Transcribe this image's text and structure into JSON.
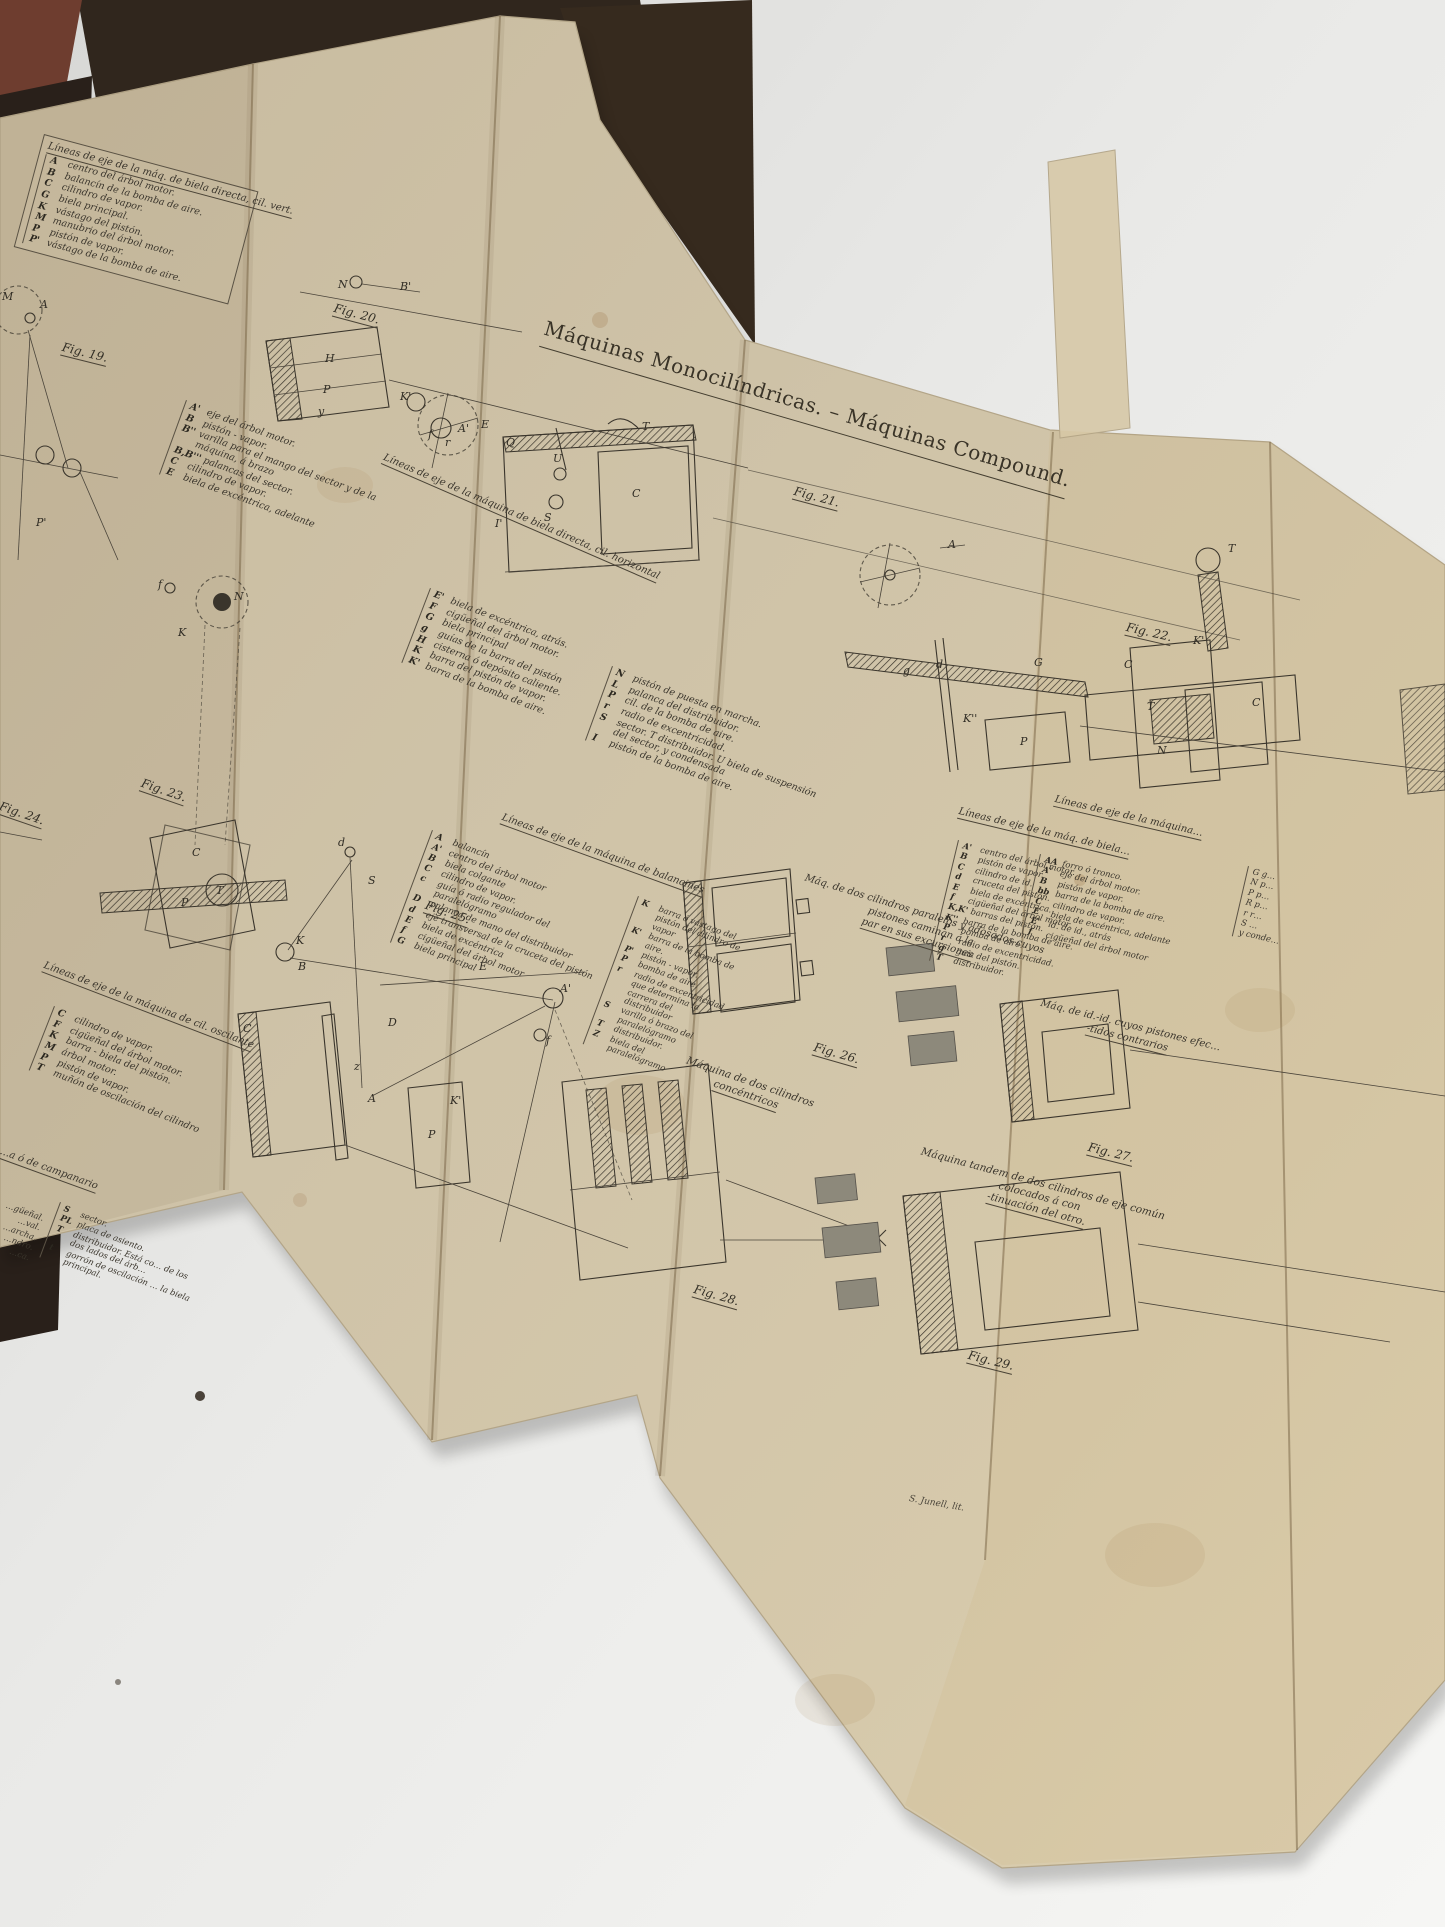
{
  "title": "Máquinas Monocilíndricas. – Máquinas Compound.",
  "signature": "S. Junell, lit.",
  "colors": {
    "paper": "#cfc3a8",
    "paper_right": "#d6c8a6",
    "ink": "#3a352c",
    "book_cover": "#30261d",
    "cover_red_edge": "#6e3d2f",
    "table_surface": "#ececea"
  },
  "lists": {
    "vert": {
      "header": "Líneas de eje de la máq. de biela directa, cil. vert.",
      "items": [
        {
          "k": "A",
          "t": "centro del árbol motor."
        },
        {
          "k": "B",
          "t": "balancín de la bomba de aire."
        },
        {
          "k": "C",
          "t": "cilindro de vapor."
        },
        {
          "k": "G",
          "t": "biela principal."
        },
        {
          "k": "K",
          "t": "vástago del pistón."
        },
        {
          "k": "M",
          "t": "manubrio del árbol motor."
        },
        {
          "k": "P",
          "t": "pistón de vapor."
        },
        {
          "k": "P'",
          "t": "vástago de la bomba de aire."
        }
      ]
    },
    "horiz": {
      "header": "Líneas de eje de la máquina de biela directa, cil. horizontal",
      "col1": [
        {
          "k": "A'",
          "t": "eje del árbol motor."
        },
        {
          "k": "B",
          "t": "pistón - vapor."
        },
        {
          "k": "B''",
          "t": "varilla para el mango del sector y de la máquina, á brazo"
        },
        {
          "k": "B,B'''",
          "t": "palancas del sector."
        },
        {
          "k": "C",
          "t": "cilindro de vapor."
        },
        {
          "k": "E",
          "t": "biela de excéntrica, adelante"
        }
      ],
      "col2": [
        {
          "k": "E'",
          "t": "biela de excéntrica, atrás."
        },
        {
          "k": "F",
          "t": "cigüeñal del árbol motor."
        },
        {
          "k": "G",
          "t": "biela principal"
        },
        {
          "k": "g",
          "t": "guías de la barra del pistón"
        },
        {
          "k": "H",
          "t": "cisterna ó depósito caliente."
        },
        {
          "k": "K",
          "t": "barra del pistón de vapor."
        },
        {
          "k": "K'",
          "t": "barra de la bomba de aire."
        }
      ],
      "col3": [
        {
          "k": "N",
          "t": "pistón de puesta en marcha."
        },
        {
          "k": "L",
          "t": "palanca del distribuidor."
        },
        {
          "k": "P",
          "t": "cil. de la bomba de aire."
        },
        {
          "k": "r",
          "t": "radio de excentricidad."
        },
        {
          "k": "S",
          "t": "sector. T distribuidor. U biela de suspensión del sector, y condensada"
        },
        {
          "k": "I",
          "t": "pistón de la bomba de aire."
        }
      ]
    },
    "balancines": {
      "header": "Líneas de eje de la máquina de balancines",
      "col1": [
        {
          "k": "A",
          "t": "balancín"
        },
        {
          "k": "A'",
          "t": "centro del árbol motor"
        },
        {
          "k": "B",
          "t": "biela colgante"
        },
        {
          "k": "C",
          "t": "cilindro de vapor."
        },
        {
          "k": "c",
          "t": "guía ó radio regulador del paralelógramo"
        },
        {
          "k": "D",
          "t": "palanca de mano del distribuidor"
        },
        {
          "k": "d",
          "t": "eje transversal de la cruceta del pistón"
        },
        {
          "k": "E",
          "t": "biela de excéntrica"
        },
        {
          "k": "f",
          "t": "cigüeñal del árbol motor"
        },
        {
          "k": "G",
          "t": "biela principal"
        }
      ],
      "col2": [
        {
          "k": "K",
          "t": "barra ó vástago del pistón del cilindro de vapor"
        },
        {
          "k": "K'",
          "t": "barra de la bomba de aire."
        },
        {
          "k": "P'",
          "t": "pistón - vapor."
        },
        {
          "k": "P",
          "t": "bomba de aire."
        },
        {
          "k": "r",
          "t": "radio de excentricidad que determina la carrera del distribuidor"
        },
        {
          "k": "S",
          "t": "varilla ó brazo del paralelógramo"
        },
        {
          "k": "T",
          "t": "distribuidor."
        },
        {
          "k": "Z",
          "t": "biela del paralelógramo"
        }
      ]
    },
    "oscilante": {
      "header": "Líneas de eje de la máquina de cil. oscilante",
      "items": [
        {
          "k": "C",
          "t": "cilindro de vapor."
        },
        {
          "k": "F",
          "t": "cigüeñal del árbol motor."
        },
        {
          "k": "K",
          "t": "barra - biela del pistón."
        },
        {
          "k": "M",
          "t": "árbol motor."
        },
        {
          "k": "P",
          "t": "pistón de vapor."
        },
        {
          "k": "T",
          "t": "muñón de oscilación del cilindro"
        }
      ]
    },
    "campanario": {
      "header": "…a ó de campanario",
      "left_fragments": [
        "…güeñal.",
        "…val.",
        "…archa.",
        "…ndro.",
        "…ca."
      ],
      "items": [
        {
          "k": "S",
          "t": "sector."
        },
        {
          "k": "PL",
          "t": "placa de asiento."
        },
        {
          "k": "T",
          "t": "distribuidor. Está co… de los dos lados del árb…"
        },
        {
          "k": "t",
          "t": "gorrón de oscilación … la biela principal."
        }
      ]
    },
    "invertida": {
      "header": "Líneas de eje de la máq. de biela…",
      "items": [
        {
          "k": "A'",
          "t": "centro del árbol motor."
        },
        {
          "k": "B",
          "t": "pistón de vapor."
        },
        {
          "k": "C",
          "t": "cilindro de id."
        },
        {
          "k": "d",
          "t": "cruceta del pistón."
        },
        {
          "k": "E",
          "t": "biela de excéntrica."
        },
        {
          "k": "f",
          "t": "cigüeñal del árbol motor."
        },
        {
          "k": "K,K'",
          "t": "barras del pistón."
        },
        {
          "k": "K''",
          "t": "barra de la bomba de aire."
        },
        {
          "k": "P",
          "t": "bomba de aire."
        },
        {
          "k": "r",
          "t": "radio de excentricidad."
        },
        {
          "k": "g",
          "t": "guía del pistón."
        },
        {
          "k": "T",
          "t": "distribuidor."
        }
      ]
    },
    "right_edge": {
      "header": "Líneas de eje de la máquina…",
      "col1": [
        {
          "k": "AA",
          "t": "forro ó tronco."
        },
        {
          "k": "A'",
          "t": "eje del árbol motor."
        },
        {
          "k": "B",
          "t": "pistón de vapor."
        },
        {
          "k": "bb",
          "t": "barra de la bomba de aire."
        },
        {
          "k": "C",
          "t": "cilindro de vapor."
        },
        {
          "k": "E",
          "t": "biela de excéntrica, adelante"
        },
        {
          "k": "E'",
          "t": "id. de id., atrás"
        },
        {
          "k": "f",
          "t": "cigüeñal del árbol motor"
        }
      ],
      "col2_fragments": [
        "G g…",
        "N p…",
        "P p…",
        "R p…",
        "r r…",
        "S …",
        "y conde…"
      ]
    }
  },
  "captions": {
    "paralelos": [
      "Máq. de dos cilindros paralelos y adosados cuyos pistones caminan á la",
      "par en sus excursiones"
    ],
    "concentricos": [
      "Máquina de dos cilindros",
      "concéntricos"
    ],
    "contrarios": [
      "Máq. de id.-id. cuyos pistones efec…",
      "-tidos contrarios"
    ],
    "tandem": [
      "Máquina tandem de dos cilindros de eje común colocados á con",
      "-tinuación del otro."
    ]
  },
  "figures": {
    "fig19": {
      "label": "Fig. 19.",
      "parts": [
        "M",
        "A",
        "P'"
      ]
    },
    "fig20": {
      "label": "Fig. 20.",
      "parts": [
        "N",
        "B'",
        "H",
        "P",
        "y",
        "K'",
        "f",
        "r",
        "A'",
        "E",
        "Q",
        "U",
        "T",
        "S",
        "C",
        "I'"
      ]
    },
    "fig21": {
      "label": "Fig. 21.",
      "parts": [
        "g",
        "d",
        "G",
        "A",
        "K''",
        "K'",
        "P",
        "T",
        "C"
      ]
    },
    "fig22": {
      "label": "Fig. 22.",
      "parts": [
        "C",
        "T",
        "N"
      ]
    },
    "fig23": {
      "label": "Fig. 23.",
      "parts": [
        "f",
        "N",
        "K",
        "C",
        "P",
        "T"
      ]
    },
    "fig24": {
      "label": "Fig. 24."
    },
    "fig25": {
      "label": "Fig. 25.",
      "parts": [
        "d",
        "S",
        "K",
        "B",
        "E",
        "A'",
        "f",
        "D",
        "z",
        "A",
        "P",
        "K'",
        "C"
      ]
    },
    "fig26": {
      "label": "Fig. 26."
    },
    "fig27": {
      "label": "Fig. 27."
    },
    "fig28": {
      "label": "Fig. 28."
    },
    "fig29": {
      "label": "Fig. 29."
    }
  }
}
